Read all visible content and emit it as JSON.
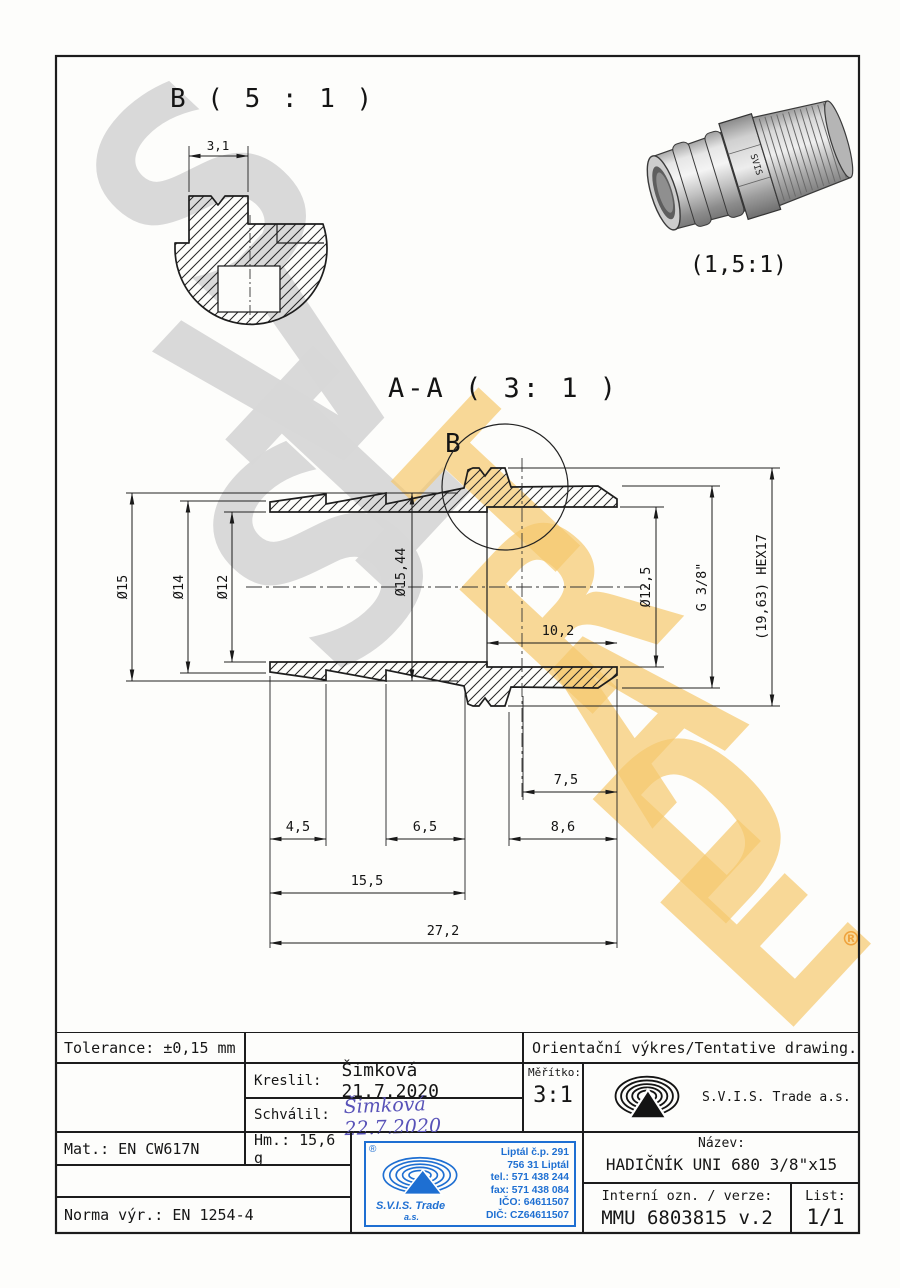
{
  "watermark": {
    "letters_gray": [
      "S",
      "V",
      "I",
      "S"
    ],
    "letters_orange": [
      "T",
      "R",
      "A",
      "D",
      "E"
    ],
    "registered": "®",
    "gray_color": "#d8d8d8",
    "orange_color": "#f6c96e"
  },
  "detail_view": {
    "title": "B ( 5 : 1 )",
    "width_dim": "3,1"
  },
  "section_view": {
    "title": "A-A ( 3: 1 )",
    "detail_label": "B",
    "dia_15": "Ø15",
    "dia_14": "Ø14",
    "dia_12": "Ø12",
    "dia_15_44": "Ø15,44",
    "dia_12_5": "Ø12,5",
    "thread": "G 3/8\"",
    "hex": "(19,63) HEX17",
    "len_10_2": "10,2",
    "len_7_5": "7,5",
    "len_4_5": "4,5",
    "len_6_5": "6,5",
    "len_8_6": "8,6",
    "len_15_5": "15,5",
    "len_27_2": "27,2"
  },
  "render_view": {
    "scale": "(1,5:1)",
    "engraving": "SVIS"
  },
  "title_block": {
    "tolerance": "Tolerance: ±0,15 mm",
    "orientation": "Orientační výkres/Tentative drawing.",
    "drawn_label": "Kreslil:",
    "drawn_value": "Šimková 21.7.2020",
    "approved_label": "Schválil:",
    "approved_signature": "Šimková 22.7.2020",
    "scale_label": "Měřítko:",
    "scale_value": "3:1",
    "company": "S.V.I.S. Trade a.s.",
    "material": "Mat.: EN CW617N",
    "weight": "Hm.: 15,6 g",
    "standard": "Norma výr.: EN 1254-4",
    "name_label": "Název:",
    "name_value": "HADIČNÍK UNI 680 3/8\"x15",
    "internal_label": "Interní ozn. / verze:",
    "internal_value": "MMU 6803815 v.2",
    "sheet_label": "List:",
    "sheet_value": "1/1"
  },
  "stamp": {
    "registered": "®",
    "company_line1": "S.V.I.S. Trade",
    "company_line2": "a.s.",
    "lines": [
      "Liptál č.p. 291",
      "756 31 Liptál",
      "tel.: 571 438 244",
      "fax: 571 438 084",
      "IČO: 64611507",
      "DIČ: CZ64611507"
    ],
    "color": "#1e6fd2"
  }
}
